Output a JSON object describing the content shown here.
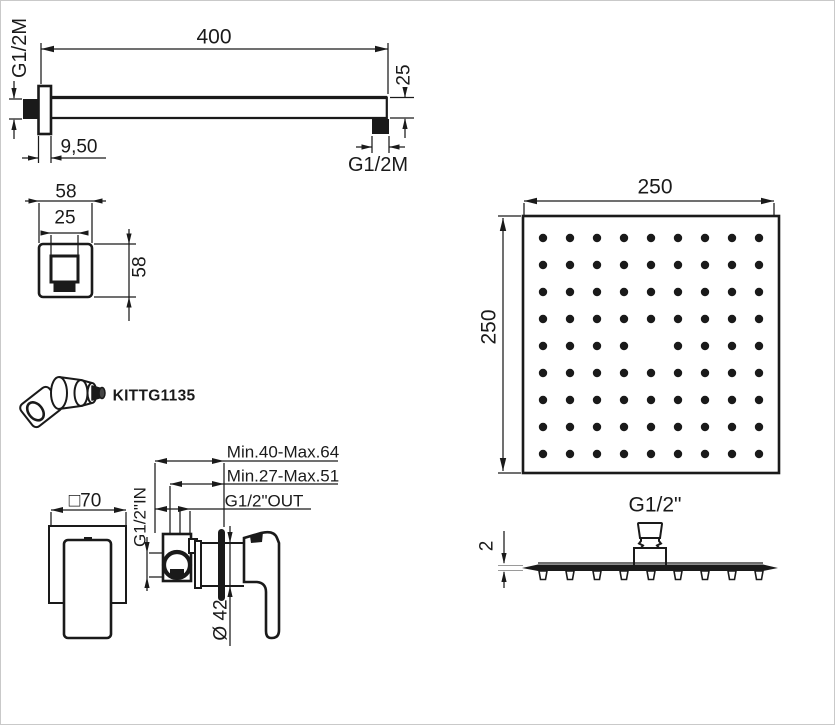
{
  "kit": {
    "code": "KITTG1135"
  },
  "arm_view": {
    "length": "400",
    "height": "25",
    "wall_thread": "G1/2M",
    "end_thread": "G1/2M",
    "flange_depth": "9,50"
  },
  "flange_view": {
    "width": "58",
    "inner_width": "25",
    "height": "58"
  },
  "mixer_view": {
    "plate_size": "□70",
    "inlet": "G1/2\"IN",
    "outlet": "G1/2\"OUT",
    "depth_range_total": "Min.40-Max.64",
    "depth_range_rough": "Min.27-Max.51",
    "trim_diameter": "Ø 42"
  },
  "head_face_view": {
    "width": "250",
    "height": "250",
    "grid": {
      "rows": 9,
      "cols": 9,
      "missing": [
        [
          4,
          4
        ]
      ]
    }
  },
  "head_side_view": {
    "thread": "G1/2\"",
    "thickness": "2"
  },
  "colors": {
    "line": "#1a1a1a",
    "background": "#ffffff",
    "frame": "#c9c9c9"
  }
}
